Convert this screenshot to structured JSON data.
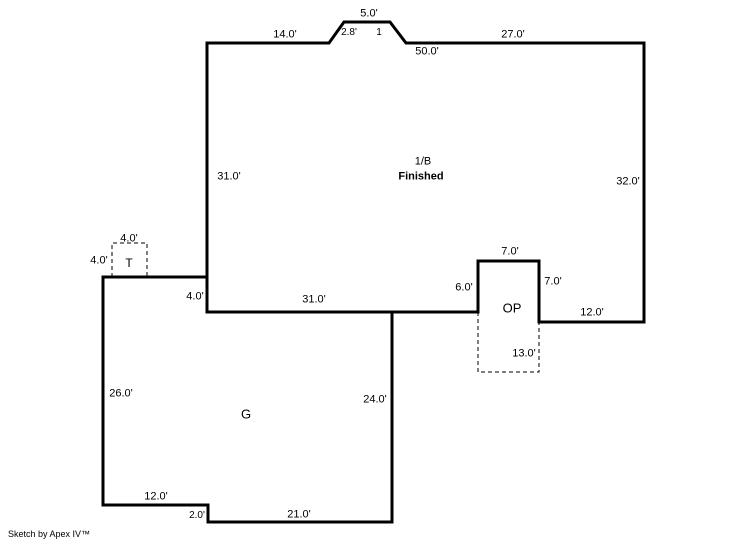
{
  "sketch": {
    "credit": "Sketch by Apex IV™",
    "colors": {
      "line": "#000000",
      "background": "#ffffff"
    },
    "areas": {
      "main_floor": {
        "code": "1/B",
        "status": "Finished"
      },
      "garage": {
        "code": "G"
      },
      "open_porch": {
        "code": "OP"
      },
      "stoop": {
        "code": "T"
      }
    },
    "dimensions": {
      "main_top_left": "14.0'",
      "bay_top": "5.0'",
      "bay_left_slope": "2.8'",
      "bay_right_slope": "1",
      "main_top_right": "27.0'",
      "main_top_total": "50.0'",
      "main_left": "31.0'",
      "main_right": "32.0'",
      "stoop_top": "4.0'",
      "stoop_left": "4.0'",
      "main_left_jog": "4.0'",
      "main_bottom_left": "31.0'",
      "porch_left": "6.0'",
      "porch_top": "7.0'",
      "porch_right": "7.0'",
      "porch_depth": "13.0'",
      "main_bottom_right": "12.0'",
      "garage_left": "26.0'",
      "garage_right": "24.0'",
      "garage_bottom_left": "12.0'",
      "garage_step": "2.0'",
      "garage_bottom": "21.0'"
    }
  }
}
